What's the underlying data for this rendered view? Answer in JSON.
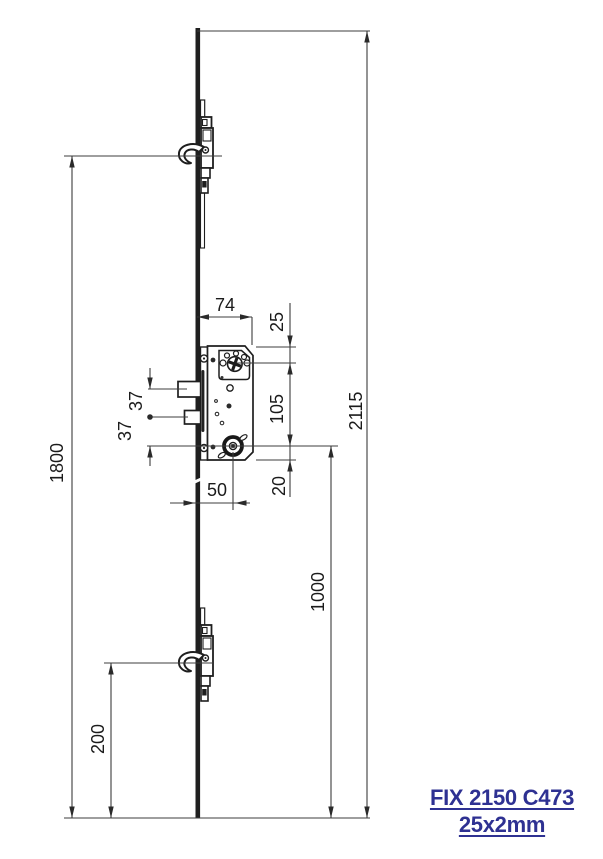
{
  "product": {
    "title": "FIX 2150 C473",
    "subtitle": "25x2mm",
    "accent_color": "#2e3192"
  },
  "dims": {
    "overall": "2115",
    "upper_hook": "1800",
    "lower_hook": "200",
    "cylinder_height": "1000",
    "case_depth": "74",
    "backset": "50",
    "edge_to_follower": "25",
    "follower_to_cylinder": "105",
    "cylinder_to_edge": "20",
    "pair37": [
      "37",
      "37"
    ]
  },
  "colors": {
    "outline": "#1e1e1e",
    "dim_line": "#3d3d3d"
  }
}
